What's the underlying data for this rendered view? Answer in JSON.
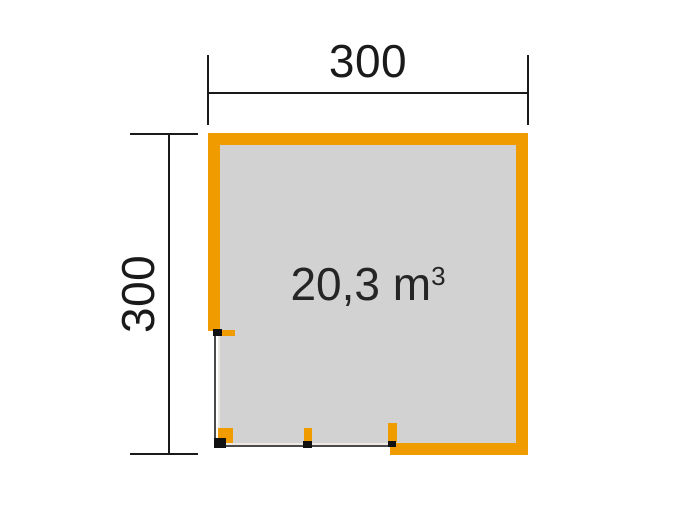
{
  "floorplan": {
    "title": "garden-house floor plan",
    "width_dimension": {
      "label": "300"
    },
    "depth_dimension": {
      "label": "300"
    },
    "volume": {
      "base": "20,3 m",
      "exponent": "3",
      "full": "20,3 m³"
    },
    "colors": {
      "wall_orange": "#F09C00",
      "floor_gray": "#D2D2D2",
      "dimension_black": "#1A1A1A",
      "post_marker_black": "#111111",
      "background": "#FFFFFF"
    }
  }
}
